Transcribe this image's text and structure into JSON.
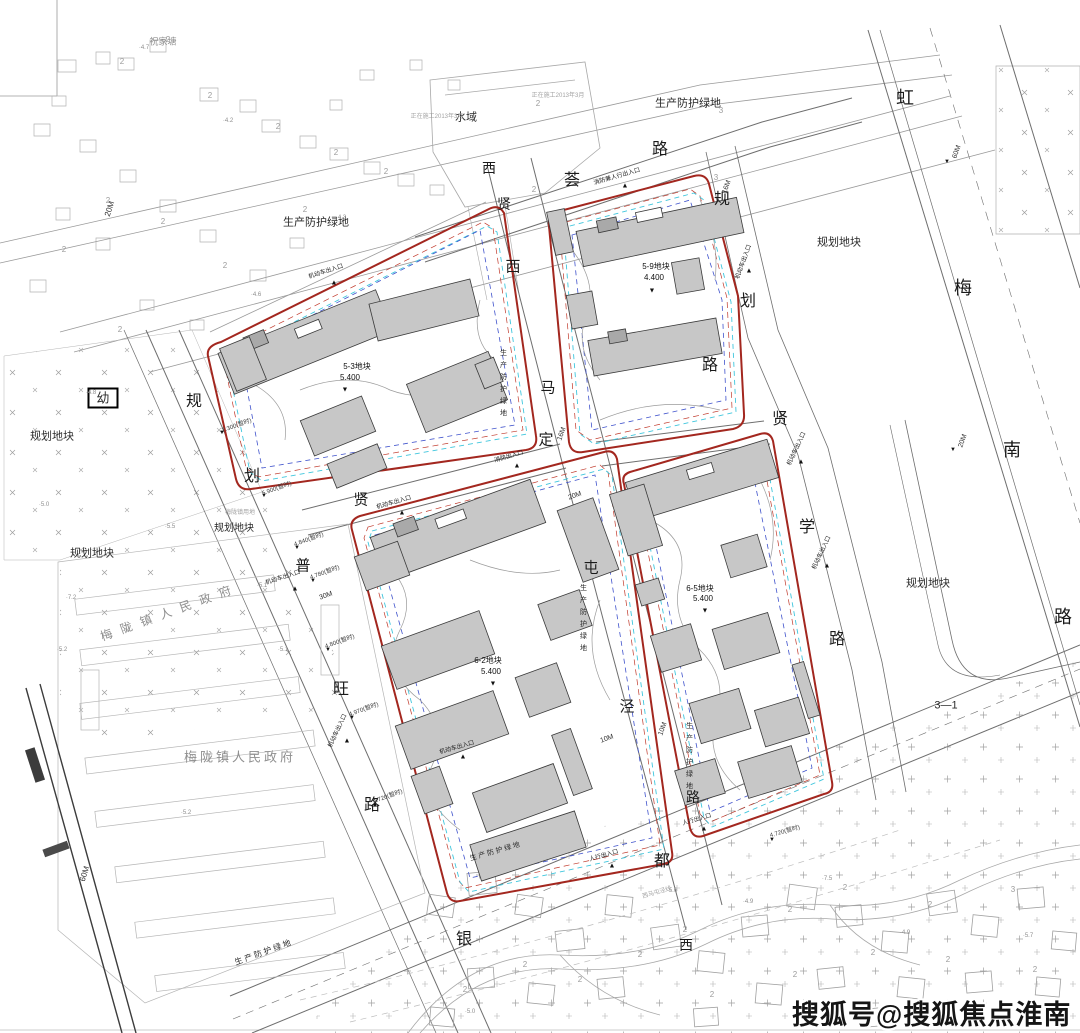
{
  "watermark": {
    "text": "搜狐号@搜狐焦点淮南站",
    "color": "#151515",
    "halo": "#ffffff"
  },
  "palette": {
    "parcel_boundary_red": "#a3271f",
    "red_dashed": "#c0392b",
    "cyan_dashed": "#3fc6dd",
    "blue_dashed": "#4053cc",
    "building_fill": "#c7c7c7",
    "building_stroke": "#3a3a3a",
    "context_line": "#b3b3b3",
    "road_line": "#6e6e6e"
  },
  "labels": {
    "roads": [
      {
        "t": "虹",
        "x": 905,
        "y": 98,
        "s": 18
      },
      {
        "t": "梅",
        "x": 963,
        "y": 288,
        "s": 18
      },
      {
        "t": "南",
        "x": 1012,
        "y": 450,
        "s": 18
      },
      {
        "t": "路",
        "x": 1063,
        "y": 617,
        "s": 18
      },
      {
        "t": "规",
        "x": 722,
        "y": 200,
        "s": 16
      },
      {
        "t": "划",
        "x": 748,
        "y": 302,
        "s": 16
      },
      {
        "t": "路",
        "x": 710,
        "y": 366,
        "s": 16
      },
      {
        "t": "贤",
        "x": 780,
        "y": 420,
        "s": 16
      },
      {
        "t": "学",
        "x": 807,
        "y": 528,
        "s": 16
      },
      {
        "t": "路",
        "x": 837,
        "y": 640,
        "s": 16
      },
      {
        "t": "西",
        "x": 489,
        "y": 168,
        "s": 14
      },
      {
        "t": "贤",
        "x": 504,
        "y": 204,
        "s": 14
      },
      {
        "t": "荟",
        "x": 572,
        "y": 181,
        "s": 16
      },
      {
        "t": "路",
        "x": 660,
        "y": 150,
        "s": 16
      },
      {
        "t": "西",
        "x": 513,
        "y": 267,
        "s": 15
      },
      {
        "t": "马",
        "x": 548,
        "y": 388,
        "s": 15
      },
      {
        "t": "定",
        "x": 546,
        "y": 440,
        "s": 15
      },
      {
        "t": "屯",
        "x": 591,
        "y": 568,
        "s": 15
      },
      {
        "t": "泾",
        "x": 627,
        "y": 707,
        "s": 15
      },
      {
        "t": "规",
        "x": 194,
        "y": 402,
        "s": 16
      },
      {
        "t": "划",
        "x": 252,
        "y": 477,
        "s": 16
      },
      {
        "t": "贤",
        "x": 361,
        "y": 500,
        "s": 15
      },
      {
        "t": "普",
        "x": 303,
        "y": 566,
        "s": 15
      },
      {
        "t": "旺",
        "x": 341,
        "y": 690,
        "s": 16
      },
      {
        "t": "路",
        "x": 372,
        "y": 806,
        "s": 16
      },
      {
        "t": "银",
        "x": 464,
        "y": 940,
        "s": 16
      },
      {
        "t": "都",
        "x": 662,
        "y": 862,
        "s": 16
      },
      {
        "t": "路",
        "x": 693,
        "y": 797,
        "s": 14
      },
      {
        "t": "西",
        "x": 686,
        "y": 945,
        "s": 14
      }
    ],
    "areas": [
      {
        "t": "祝家塘",
        "x": 163,
        "y": 42,
        "s": 9,
        "cls": "gray"
      },
      {
        "t": "水域",
        "x": 466,
        "y": 118,
        "s": 11
      },
      {
        "t": "生产防护绿地",
        "x": 688,
        "y": 104,
        "s": 11
      },
      {
        "t": "生产防护绿地",
        "x": 316,
        "y": 223,
        "s": 11
      },
      {
        "t": "生 产 防 护 绿 地",
        "x": 495,
        "y": 852,
        "s": 7,
        "r": -16
      },
      {
        "t": "生 产 防 护 绿 地",
        "x": 263,
        "y": 953,
        "s": 8,
        "r": -20
      },
      {
        "t": "生产防护绿地",
        "x": 503,
        "y": 385,
        "s": 7,
        "v": 1
      },
      {
        "t": "生产防护绿地",
        "x": 583,
        "y": 620,
        "s": 7,
        "v": 1
      },
      {
        "t": "生产防护绿地",
        "x": 689,
        "y": 758,
        "s": 7,
        "v": 1
      },
      {
        "t": "规划地块",
        "x": 52,
        "y": 437,
        "s": 11
      },
      {
        "t": "规划地块",
        "x": 92,
        "y": 554,
        "s": 11
      },
      {
        "t": "规划地块",
        "x": 234,
        "y": 529,
        "s": 10
      },
      {
        "t": "规划地块",
        "x": 839,
        "y": 243,
        "s": 11
      },
      {
        "t": "规划地块",
        "x": 928,
        "y": 584,
        "s": 11
      },
      {
        "t": "梅陇镇人民政府",
        "x": 170,
        "y": 612,
        "s": 12,
        "r": -20,
        "cls": "gray",
        "ls": 9
      },
      {
        "t": "梅陇镇人民政府",
        "x": 240,
        "y": 757,
        "s": 13,
        "cls": "gray",
        "ls": 3
      },
      {
        "t": "幼",
        "x": 103,
        "y": 398,
        "s": 13,
        "box": 1
      },
      {
        "t": "3—1",
        "x": 946,
        "y": 706,
        "s": 11
      }
    ],
    "parcels": [
      {
        "t": "5-9地块",
        "x": 656,
        "y": 267,
        "s": 8
      },
      {
        "t": "4.400",
        "x": 654,
        "y": 278,
        "s": 8
      },
      {
        "t": "▼",
        "x": 652,
        "y": 291,
        "s": 7
      },
      {
        "t": "5-3地块",
        "x": 357,
        "y": 367,
        "s": 8
      },
      {
        "t": "5.400",
        "x": 350,
        "y": 378,
        "s": 8
      },
      {
        "t": "▼",
        "x": 345,
        "y": 390,
        "s": 7
      },
      {
        "t": "6-2地块",
        "x": 488,
        "y": 661,
        "s": 8
      },
      {
        "t": "5.400",
        "x": 491,
        "y": 672,
        "s": 8
      },
      {
        "t": "▼",
        "x": 493,
        "y": 684,
        "s": 7
      },
      {
        "t": "6-5地块",
        "x": 700,
        "y": 589,
        "s": 8
      },
      {
        "t": "5.400",
        "x": 703,
        "y": 599,
        "s": 8
      },
      {
        "t": "▼",
        "x": 705,
        "y": 611,
        "s": 7
      }
    ],
    "entrances": [
      {
        "t": "消防兼人行出入口",
        "x": 617,
        "y": 177,
        "s": 6,
        "r": -16
      },
      {
        "t": "机动车出入口",
        "x": 326,
        "y": 272,
        "s": 6,
        "r": -18
      },
      {
        "t": "机动车出入口",
        "x": 744,
        "y": 262,
        "s": 6,
        "r": -70
      },
      {
        "t": "机动车出入口",
        "x": 797,
        "y": 449,
        "s": 6,
        "r": -65
      },
      {
        "t": "机动车出入口",
        "x": 822,
        "y": 553,
        "s": 6,
        "r": -65
      },
      {
        "t": "机动车出入口",
        "x": 283,
        "y": 578,
        "s": 6,
        "r": -18
      },
      {
        "t": "机动车出入口",
        "x": 338,
        "y": 731,
        "s": 6,
        "r": -65
      },
      {
        "t": "机动车出入口",
        "x": 394,
        "y": 503,
        "s": 6,
        "r": -16
      },
      {
        "t": "机动车出入口",
        "x": 457,
        "y": 748,
        "s": 6,
        "r": -16
      },
      {
        "t": "消防出入口",
        "x": 509,
        "y": 457,
        "s": 6,
        "r": -16
      },
      {
        "t": "人行出入口",
        "x": 604,
        "y": 856,
        "s": 6,
        "r": -16
      },
      {
        "t": "人行出入口",
        "x": 697,
        "y": 820,
        "s": 6,
        "r": -16
      }
    ],
    "dims": [
      {
        "t": "60M",
        "x": 957,
        "y": 152,
        "s": 7,
        "r": -70
      },
      {
        "t": "20M",
        "x": 963,
        "y": 441,
        "s": 7,
        "r": -70
      },
      {
        "t": "20M",
        "x": 110,
        "y": 209,
        "s": 8,
        "r": -72
      },
      {
        "t": "60M",
        "x": 85,
        "y": 874,
        "s": 8,
        "r": -72
      },
      {
        "t": "30M",
        "x": 326,
        "y": 596,
        "s": 7,
        "r": -20
      },
      {
        "t": "20M",
        "x": 575,
        "y": 496,
        "s": 7,
        "r": -20
      },
      {
        "t": "10M",
        "x": 607,
        "y": 739,
        "s": 7,
        "r": -20
      },
      {
        "t": "10M",
        "x": 663,
        "y": 729,
        "s": 7,
        "r": -70
      },
      {
        "t": "16M",
        "x": 727,
        "y": 187,
        "s": 7,
        "r": -70
      },
      {
        "t": "16M",
        "x": 562,
        "y": 434,
        "s": 7,
        "r": -70
      }
    ],
    "spots": [
      {
        "t": "7.300(暂时)",
        "x": 237,
        "y": 426,
        "s": 6,
        "r": -20
      },
      {
        "t": "5.900(暂时)",
        "x": 277,
        "y": 489,
        "s": 6,
        "r": -20
      },
      {
        "t": "4.840(暂时)",
        "x": 309,
        "y": 540,
        "s": 6,
        "r": -20
      },
      {
        "t": "4.780(暂时)",
        "x": 325,
        "y": 573,
        "s": 6,
        "r": -20
      },
      {
        "t": "4.800(暂时)",
        "x": 340,
        "y": 642,
        "s": 6,
        "r": -20
      },
      {
        "t": "4.970(暂时)",
        "x": 364,
        "y": 710,
        "s": 6,
        "r": -20
      },
      {
        "t": "4.720(暂时)",
        "x": 388,
        "y": 797,
        "s": 6,
        "r": -20
      },
      {
        "t": "4.720(暂时)",
        "x": 785,
        "y": 832,
        "s": 6,
        "r": -16
      }
    ],
    "elevations": [
      {
        "t": "·4.7",
        "x": 144,
        "y": 48,
        "s": 6
      },
      {
        "t": "·4.2",
        "x": 228,
        "y": 121,
        "s": 6
      },
      {
        "t": "·4.3",
        "x": 341,
        "y": 218,
        "s": 6
      },
      {
        "t": "·4.6",
        "x": 256,
        "y": 295,
        "s": 6
      },
      {
        "t": "·4.8",
        "x": 91,
        "y": 393,
        "s": 6
      },
      {
        "t": "·5.0",
        "x": 44,
        "y": 505,
        "s": 6
      },
      {
        "t": "·5.5",
        "x": 170,
        "y": 527,
        "s": 6
      },
      {
        "t": "·7.2",
        "x": 71,
        "y": 598,
        "s": 6
      },
      {
        "t": "·5.1",
        "x": 262,
        "y": 586,
        "s": 6
      },
      {
        "t": "·5.2",
        "x": 62,
        "y": 650,
        "s": 6
      },
      {
        "t": "·5.1",
        "x": 283,
        "y": 650,
        "s": 6
      },
      {
        "t": "·5.2",
        "x": 186,
        "y": 813,
        "s": 6
      },
      {
        "t": "·5.6",
        "x": 672,
        "y": 891,
        "s": 6
      },
      {
        "t": "·7.5",
        "x": 827,
        "y": 879,
        "s": 6
      },
      {
        "t": "·4.9",
        "x": 748,
        "y": 902,
        "s": 6
      },
      {
        "t": "·4.9",
        "x": 905,
        "y": 933,
        "s": 6
      },
      {
        "t": "·5.7",
        "x": 1028,
        "y": 936,
        "s": 6
      },
      {
        "t": "·5.0",
        "x": 470,
        "y": 1012,
        "s": 6
      }
    ],
    "notes": [
      {
        "t": "正在施工2013年3月",
        "x": 437,
        "y": 117,
        "s": 6
      },
      {
        "t": "正在施工2013年3月",
        "x": 558,
        "y": 96,
        "s": 6
      },
      {
        "t": "西马屯泾线",
        "x": 657,
        "y": 893,
        "s": 6,
        "r": -16
      },
      {
        "t": "梅陇镇用地",
        "x": 240,
        "y": 513,
        "s": 6
      }
    ],
    "context_numbers": [
      {
        "t": "2",
        "x": 122,
        "y": 62,
        "s": 8
      },
      {
        "t": "2",
        "x": 168,
        "y": 40,
        "s": 8
      },
      {
        "t": "2",
        "x": 210,
        "y": 96,
        "s": 8
      },
      {
        "t": "2",
        "x": 278,
        "y": 127,
        "s": 8
      },
      {
        "t": "2",
        "x": 336,
        "y": 153,
        "s": 8
      },
      {
        "t": "2",
        "x": 386,
        "y": 172,
        "s": 8
      },
      {
        "t": "2",
        "x": 108,
        "y": 201,
        "s": 8
      },
      {
        "t": "2",
        "x": 64,
        "y": 250,
        "s": 8
      },
      {
        "t": "2",
        "x": 163,
        "y": 222,
        "s": 8
      },
      {
        "t": "2",
        "x": 225,
        "y": 266,
        "s": 8
      },
      {
        "t": "2",
        "x": 305,
        "y": 210,
        "s": 8
      },
      {
        "t": "2",
        "x": 120,
        "y": 330,
        "s": 8
      },
      {
        "t": "2",
        "x": 538,
        "y": 104,
        "s": 8
      },
      {
        "t": "2",
        "x": 534,
        "y": 190,
        "s": 8
      },
      {
        "t": "3",
        "x": 721,
        "y": 111,
        "s": 8
      },
      {
        "t": "3",
        "x": 716,
        "y": 178,
        "s": 8
      },
      {
        "t": "2",
        "x": 845,
        "y": 888,
        "s": 8
      },
      {
        "t": "2",
        "x": 790,
        "y": 910,
        "s": 8
      },
      {
        "t": "2",
        "x": 930,
        "y": 905,
        "s": 8
      },
      {
        "t": "3",
        "x": 1013,
        "y": 890,
        "s": 8
      },
      {
        "t": "2",
        "x": 873,
        "y": 953,
        "s": 8
      },
      {
        "t": "2",
        "x": 948,
        "y": 960,
        "s": 8
      },
      {
        "t": "2",
        "x": 795,
        "y": 975,
        "s": 8
      },
      {
        "t": "2",
        "x": 1035,
        "y": 970,
        "s": 8
      },
      {
        "t": "2",
        "x": 685,
        "y": 930,
        "s": 8
      },
      {
        "t": "2",
        "x": 640,
        "y": 955,
        "s": 8
      },
      {
        "t": "2",
        "x": 580,
        "y": 980,
        "s": 8
      },
      {
        "t": "2",
        "x": 525,
        "y": 965,
        "s": 8
      },
      {
        "t": "2",
        "x": 465,
        "y": 990,
        "s": 8
      },
      {
        "t": "2",
        "x": 712,
        "y": 995,
        "s": 8
      },
      {
        "t": "2",
        "x": 870,
        "y": 1010,
        "s": 8
      }
    ],
    "markers": [
      {
        "t": "▲",
        "x": 625,
        "y": 186,
        "s": 7
      },
      {
        "t": "▲",
        "x": 334,
        "y": 283,
        "s": 7
      },
      {
        "t": "▲",
        "x": 749,
        "y": 271,
        "s": 7
      },
      {
        "t": "▲",
        "x": 801,
        "y": 462,
        "s": 7
      },
      {
        "t": "▲",
        "x": 827,
        "y": 566,
        "s": 7
      },
      {
        "t": "▲",
        "x": 295,
        "y": 589,
        "s": 7
      },
      {
        "t": "▲",
        "x": 347,
        "y": 741,
        "s": 7
      },
      {
        "t": "▲",
        "x": 402,
        "y": 513,
        "s": 7
      },
      {
        "t": "▲",
        "x": 612,
        "y": 866,
        "s": 7
      },
      {
        "t": "▲",
        "x": 704,
        "y": 829,
        "s": 7
      },
      {
        "t": "▲",
        "x": 517,
        "y": 466,
        "s": 7
      },
      {
        "t": "▲",
        "x": 463,
        "y": 757,
        "s": 7
      },
      {
        "t": "▼",
        "x": 222,
        "y": 433,
        "s": 6
      },
      {
        "t": "▼",
        "x": 264,
        "y": 496,
        "s": 6
      },
      {
        "t": "▼",
        "x": 297,
        "y": 548,
        "s": 6
      },
      {
        "t": "▼",
        "x": 313,
        "y": 581,
        "s": 6
      },
      {
        "t": "▼",
        "x": 328,
        "y": 650,
        "s": 6
      },
      {
        "t": "▼",
        "x": 352,
        "y": 718,
        "s": 6
      },
      {
        "t": "▼",
        "x": 375,
        "y": 806,
        "s": 6
      },
      {
        "t": "▼",
        "x": 772,
        "y": 840,
        "s": 6
      },
      {
        "t": "▼",
        "x": 947,
        "y": 162,
        "s": 6
      },
      {
        "t": "▼",
        "x": 953,
        "y": 450,
        "s": 6
      }
    ]
  }
}
